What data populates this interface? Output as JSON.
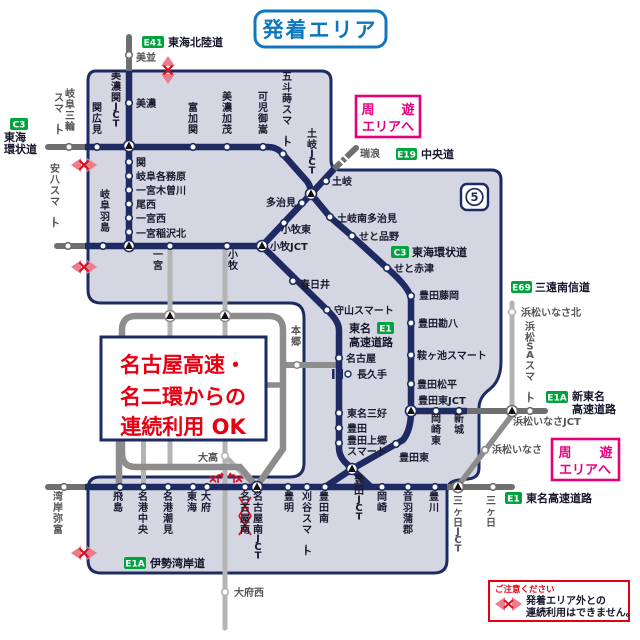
{
  "title": "発着エリア",
  "map_number": "5",
  "colors": {
    "area_fill": "#d4d6e2",
    "navy": "#1e2b63",
    "green_badge": "#00a33e",
    "pink": "#e6007e",
    "red": "#e50012",
    "blue": "#0c76bf",
    "gray_dark": "#6f6f6f",
    "gray_mid": "#8d8d8d",
    "gray_light": "#b4b4b4"
  },
  "note_box": {
    "line1": "名古屋高速・",
    "line2": "名二環からの",
    "line3": "連続利用 OK"
  },
  "shuyu_box": {
    "word1": "周",
    "word2": "遊",
    "line2": "エリアへ"
  },
  "warning_box": {
    "heading": "ご注意ください",
    "line1": "発着エリア外との",
    "line2": "連続利用はできません。"
  },
  "badges": {
    "tokai_hokuriku": {
      "code": "E41",
      "label": "東海北陸道"
    },
    "tokai_kanjo_west": {
      "code": "C3",
      "label_line1": "東海",
      "label_line2": "環状道"
    },
    "chuo": {
      "code": "E19",
      "label": "中央道"
    },
    "tokai_kanjo_mid": {
      "code": "C3",
      "label": "東海環状道"
    },
    "san_en_nanshin": {
      "code": "E69",
      "label": "三遠南信道"
    },
    "tomei": {
      "code": "E1",
      "label_line1": "東名",
      "label_line2": "高速道路"
    },
    "shin_tomei": {
      "code": "E1A",
      "label_line1": "新東名",
      "label_line2": "高速道路"
    },
    "tomei_east": {
      "code": "E1",
      "label": "東名高速道路"
    },
    "isewangan": {
      "code": "E1A",
      "label": "伊勢湾岸道"
    }
  },
  "stations_h": [
    {
      "label": "美並"
    },
    {
      "label": "美濃"
    },
    {
      "label": "関"
    },
    {
      "label": "岐阜各務原"
    },
    {
      "label": "一宮木曽川"
    },
    {
      "label": "尾西"
    },
    {
      "label": "一宮西"
    },
    {
      "label": "一宮稲沢北"
    },
    {
      "label": "多治見"
    },
    {
      "label": "土岐"
    },
    {
      "label": "瑞浪"
    },
    {
      "label": "小牧東"
    },
    {
      "label": "小牧JCT"
    },
    {
      "label": "春日井"
    },
    {
      "label": "守山スマート"
    },
    {
      "label": "名古屋"
    },
    {
      "label": "長久手"
    },
    {
      "label": "東名三好"
    },
    {
      "label": "豊田"
    },
    {
      "label": "豊田上郷"
    },
    {
      "label": "スマート"
    },
    {
      "label": "土岐南多治見"
    },
    {
      "label": "せと品野"
    },
    {
      "label": "せと赤津"
    },
    {
      "label": "豊田藤岡"
    },
    {
      "label": "豊田勘八"
    },
    {
      "label": "鞍ヶ池スマート"
    },
    {
      "label": "豊田松平"
    },
    {
      "label": "豊田東JCT"
    },
    {
      "label": "豊田東"
    },
    {
      "label": "浜松いなさ北"
    },
    {
      "label": "浜松いなさJCT"
    },
    {
      "label": "浜松いなさ"
    },
    {
      "label": "大高"
    },
    {
      "label": "大府西"
    }
  ],
  "stations_v": [
    {
      "label": "岐阜三輪"
    },
    {
      "label": "スマート"
    },
    {
      "label": "安八スマート"
    },
    {
      "label": "湾岸弥富"
    },
    {
      "label": "岐阜羽島"
    },
    {
      "label": "美濃関JCT"
    },
    {
      "label": "関広見"
    },
    {
      "label": "富加関"
    },
    {
      "label": "美濃加茂"
    },
    {
      "label": "可児御嵩"
    },
    {
      "label": "五斗蒔スマート"
    },
    {
      "label": "一宮"
    },
    {
      "label": "小牧"
    },
    {
      "label": "土岐JCT"
    },
    {
      "label": "本郷"
    },
    {
      "label": "浜松SAスマート"
    },
    {
      "label": "飛島"
    },
    {
      "label": "名港中央"
    },
    {
      "label": "名港潮見"
    },
    {
      "label": "東海"
    },
    {
      "label": "大府"
    },
    {
      "label": "名古屋南"
    },
    {
      "label": "名古屋南JCT"
    },
    {
      "label": "豊明"
    },
    {
      "label": "刈谷スマート"
    },
    {
      "label": "豊田南"
    },
    {
      "label": "豊田JCT"
    },
    {
      "label": "岡崎"
    },
    {
      "label": "音羽蒲郡"
    },
    {
      "label": "豊川"
    },
    {
      "label": "三ヶ日JCT"
    },
    {
      "label": "三ヶ日"
    },
    {
      "label": "岡崎東"
    },
    {
      "label": "新城"
    }
  ]
}
